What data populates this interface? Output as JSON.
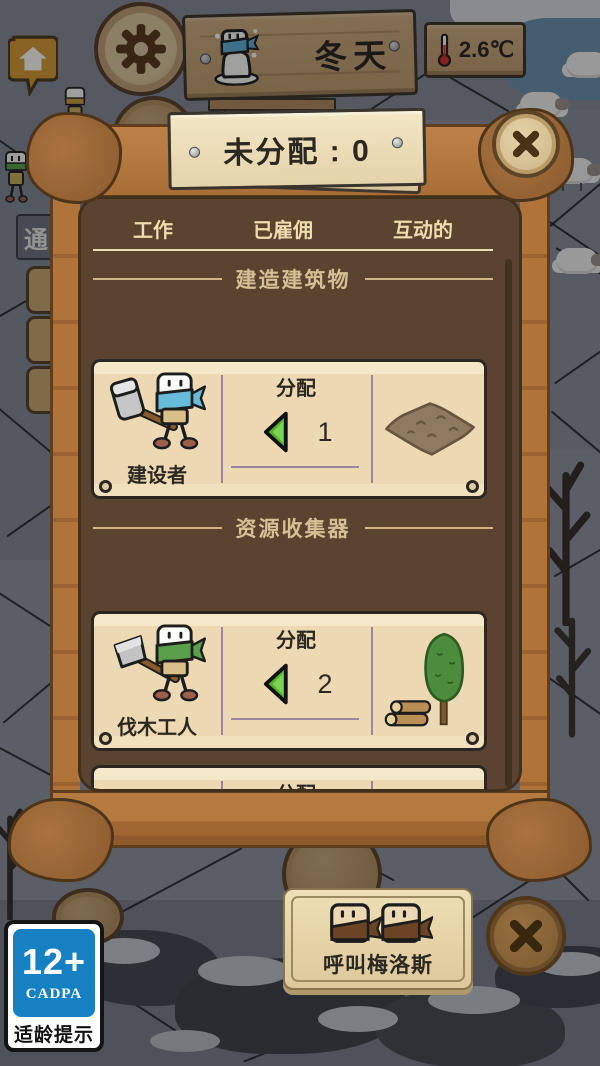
{
  "hud": {
    "season_label": "冬天",
    "temperature_value": "2.6℃",
    "left_sign_label": "通",
    "icons": {
      "settings": "gear-icon",
      "home": "house-icon",
      "season": "snowman-icon",
      "temperature": "thermometer-icon"
    }
  },
  "modal": {
    "banner_label": "未分配 : 0",
    "close_icon": "✕",
    "tabs": [
      {
        "label": "工作"
      },
      {
        "label": "已雇佣"
      },
      {
        "label": "互动的"
      }
    ],
    "sections": [
      {
        "title": "建造建筑物",
        "cards": [
          {
            "worker": "建设者",
            "assign_label": "分配",
            "count": "1",
            "resource_icon": "dirt-plot-icon",
            "arrow_icon": "green-left-arrow"
          }
        ]
      },
      {
        "title": "资源收集器",
        "cards": [
          {
            "worker": "伐木工人",
            "assign_label": "分配",
            "count": "2",
            "resource_icon": "logs-and-tree-icon",
            "arrow_icon": "green-left-arrow"
          }
        ]
      }
    ],
    "partial_card": {
      "assign_label": "分配"
    }
  },
  "footer": {
    "call_button_label": "呼叫梅洛斯",
    "call_button_icon": "two-villagers-icon",
    "close_icon": "✕"
  },
  "age_rating": {
    "age": "12+",
    "org": "CADPA",
    "caption": "适龄提示"
  },
  "colors": {
    "frame_wood": "#b0743b",
    "panel_brown": "#5a4430",
    "parchment": "#ecd9b4",
    "cream_text": "#ecdcae",
    "tan_text": "#d6bf94",
    "dark_text": "#2c2820",
    "arrow_green": "#53b22a",
    "divider_purple": "#9b86a0",
    "rating_blue": "#1681c2"
  }
}
